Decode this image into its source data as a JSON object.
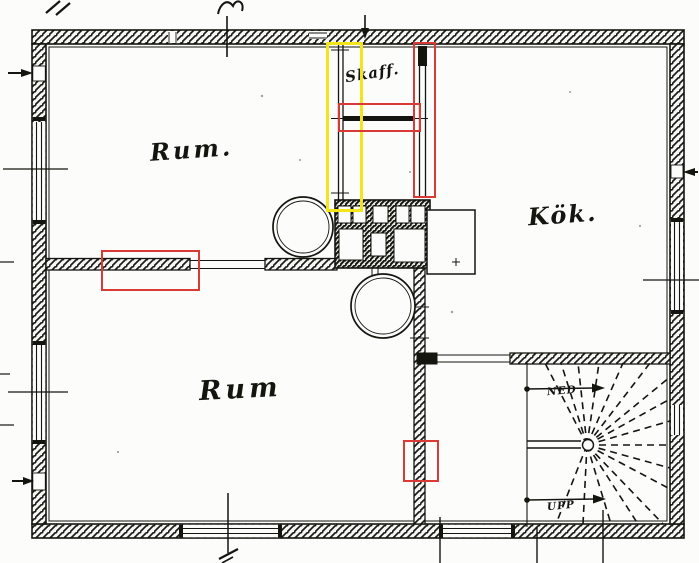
{
  "plan": {
    "rooms": {
      "room_top": "Rum.",
      "kitchen": "Kök.",
      "room_bottom": "Rum",
      "pantry": "Skaff."
    },
    "stairs": {
      "down_label": "NED",
      "up_label": "UPP"
    }
  },
  "annotations": {
    "colors": {
      "red": "#d93a35",
      "yellow": "#f2e51c"
    }
  },
  "line_color": "#15150f"
}
